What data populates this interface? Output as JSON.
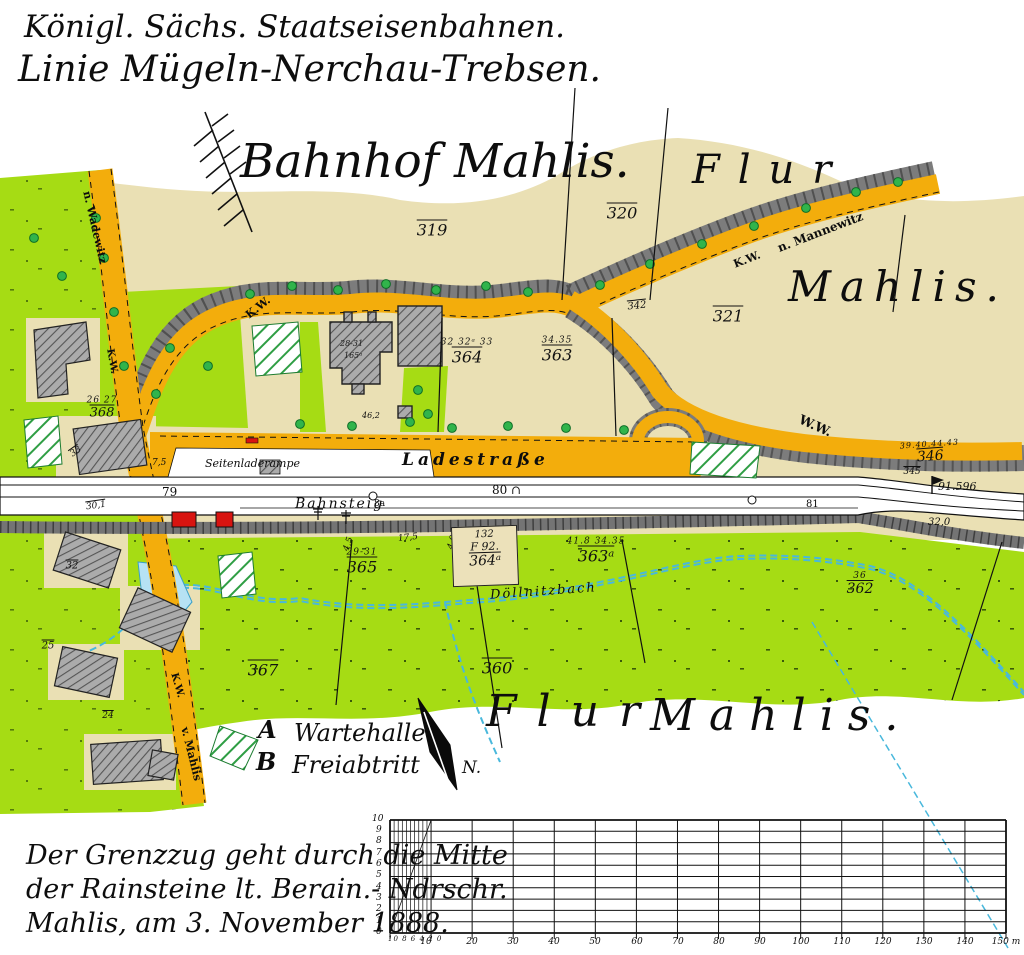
{
  "title_block": {
    "line1": "Königl. Sächs. Staatseisenbahnen.",
    "line2": "Linie Mügeln-Nerchau-Trebsen.",
    "map_title": "Bahnhof Mahlis."
  },
  "flur_labels": {
    "top_flur": "Flur",
    "right_mahlis": "Mahlis.",
    "bottom_flur": "Flur",
    "bottom_mahlis": "Mahlis."
  },
  "roads": {
    "ladestrasse": "Ladestraße",
    "seitenladerampe": "Seitenladerampe",
    "bahnsteig": "Bahnsteig",
    "stream": "Döllnitzbach",
    "kw_loop": "K.W.",
    "kw_mannewitz_road": "K.W.",
    "kw_wadewitz_road": "K.W.",
    "kw_mahlis_road": "K.W.",
    "ww": "W.W.",
    "dest_mannewitz": "n. Mannewitz",
    "dest_wadewitz": "n. Wadewitz",
    "dest_mahlis": "v. Mahlis"
  },
  "station_marks": {
    "km79": "79",
    "km8a": "8a",
    "km80": "80 ∩",
    "km81": "81",
    "kmstone": "91.596",
    "elevation": "32,0"
  },
  "measurements": {
    "rampe": "7,5",
    "m175": "17,5",
    "m40": "4,0",
    "m45": "4,5",
    "m462": "46,2"
  },
  "building_labels": {
    "station_line1": "28-31",
    "station_line2": "165ᵃ"
  },
  "parcels": {
    "p319": {
      "s": "",
      "n": "319"
    },
    "p320": {
      "s": "",
      "n": "320"
    },
    "p321": {
      "s": "",
      "n": "321"
    },
    "p342": {
      "s": "",
      "n": "342"
    },
    "p364": {
      "s": "32 32ᵃ 33",
      "n": "364"
    },
    "p363": {
      "s": "34.35",
      "n": "363"
    },
    "p368": {
      "s": "26 27",
      "n": "368"
    },
    "p365": {
      "s": "29-31",
      "n": "365"
    },
    "p363a": {
      "s": "41.8  34.35",
      "n": "363ᵃ"
    },
    "p362": {
      "s": "36",
      "n": "362"
    },
    "p360": {
      "s": "",
      "n": "360"
    },
    "p367": {
      "s": "",
      "n": "367"
    },
    "p346": {
      "s": "39.40.44.43",
      "n": "346"
    },
    "p345": {
      "s": "",
      "n": "345"
    },
    "p301": {
      "s": "",
      "n": "30,1"
    },
    "p33": {
      "s": "",
      "n": "33"
    },
    "p32": {
      "s": "",
      "n": "32"
    },
    "p24": {
      "s": "",
      "n": "24"
    },
    "p25": {
      "s": "",
      "n": "25"
    }
  },
  "parcel_364a": {
    "l1": "132",
    "l2": "F 92.",
    "l3": "364ᵃ"
  },
  "legend": {
    "a_key": "A",
    "a_label": "Wartehalle",
    "b_key": "B",
    "b_label": "Freiabtritt",
    "north": "N."
  },
  "survey_note": {
    "line1": "Der Grenzzug geht durch die Mitte",
    "line2": "der Rainsteine lt. Berain.- Ndrschr.",
    "line3": "Mahlis, am 3. November 1888."
  },
  "scale_bar": {
    "left_axis": [
      "10",
      "9",
      "8",
      "7",
      "6",
      "5",
      "4",
      "3",
      "2",
      "1",
      "0"
    ],
    "sub_labels": "10 8 6 4 2 0",
    "bottom_labels": [
      "10",
      "20",
      "30",
      "40",
      "50",
      "60",
      "70",
      "80",
      "90",
      "100",
      "110",
      "120",
      "130",
      "140"
    ],
    "end_label": "150 m"
  },
  "colors": {
    "field_tan": "#eae0b4",
    "meadow_green": "#a6dc14",
    "road_orange": "#f3ad0c",
    "embankment_gray": "#7c7c7c",
    "stream_blue": "#49b8dc",
    "building_red": "#d81410",
    "building_gray": "#ababab",
    "tree_green": "#31b44b"
  }
}
